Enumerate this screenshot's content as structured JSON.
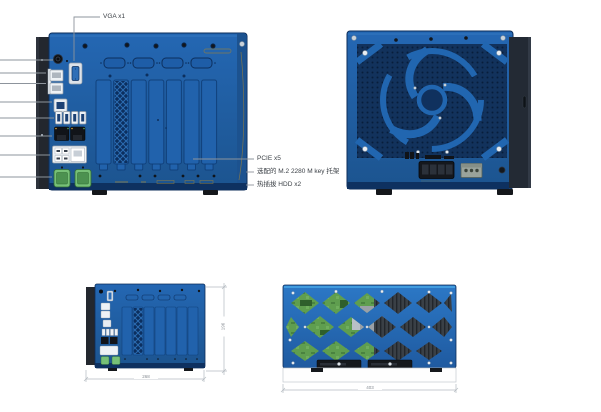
{
  "callouts": {
    "vga": "VGA x1",
    "pcie": "PCIE x5",
    "m2_bracket": "选配的 M.2 2280 M key 托架",
    "hdd": "热插拔 HDD x2"
  },
  "dimensions": {
    "front_width": "268",
    "front_height": "196",
    "bottom_width": "403"
  },
  "colors": {
    "panel_blue": "#1f5fa9",
    "panel_blue_dark": "#0d2d5a",
    "vent_navy": "#0c2f5f",
    "flange_dark": "#23272e",
    "connector_green": "#77c077",
    "pcb_green": "#5f9e4f",
    "copper_detail": "#96803f",
    "leader_gray": "#8d949c",
    "dimension_gray": "#b4bac1"
  }
}
